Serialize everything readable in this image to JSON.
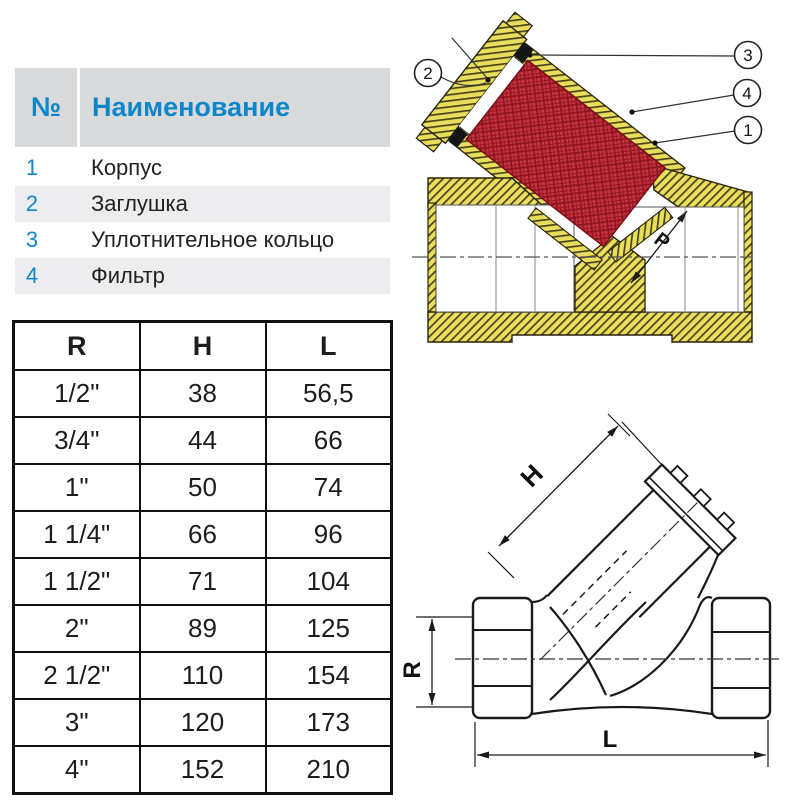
{
  "parts_table": {
    "header_num": "№",
    "header_name": "Наименование",
    "rows": [
      {
        "num": "1",
        "name": "Корпус"
      },
      {
        "num": "2",
        "name": "Заглушка"
      },
      {
        "num": "3",
        "name": "Уплотнительное кольцо"
      },
      {
        "num": "4",
        "name": "Фильтр"
      }
    ]
  },
  "dimensions_table": {
    "headers": [
      "R",
      "H",
      "L"
    ],
    "rows": [
      [
        "1/2\"",
        "38",
        "56,5"
      ],
      [
        "3/4\"",
        "44",
        "66"
      ],
      [
        "1\"",
        "50",
        "74"
      ],
      [
        "1 1/4\"",
        "66",
        "96"
      ],
      [
        "1 1/2\"",
        "71",
        "104"
      ],
      [
        "2\"",
        "89",
        "125"
      ],
      [
        "2 1/2\"",
        "110",
        "154"
      ],
      [
        "3\"",
        "120",
        "173"
      ],
      [
        "4\"",
        "152",
        "210"
      ]
    ]
  },
  "section_drawing": {
    "callouts": [
      "2",
      "3",
      "4",
      "1"
    ],
    "p_label": "P"
  },
  "outline_drawing": {
    "h_label": "H",
    "r_label": "R",
    "l_label": "L"
  },
  "colors": {
    "header_blue": "#0e86ca",
    "header_bg": "#d9dadc",
    "row_stripe": "#ededef",
    "brass_yellow": "#e9df5c",
    "filter_red": "#c8333e",
    "line_black": "#1a1a1a"
  }
}
